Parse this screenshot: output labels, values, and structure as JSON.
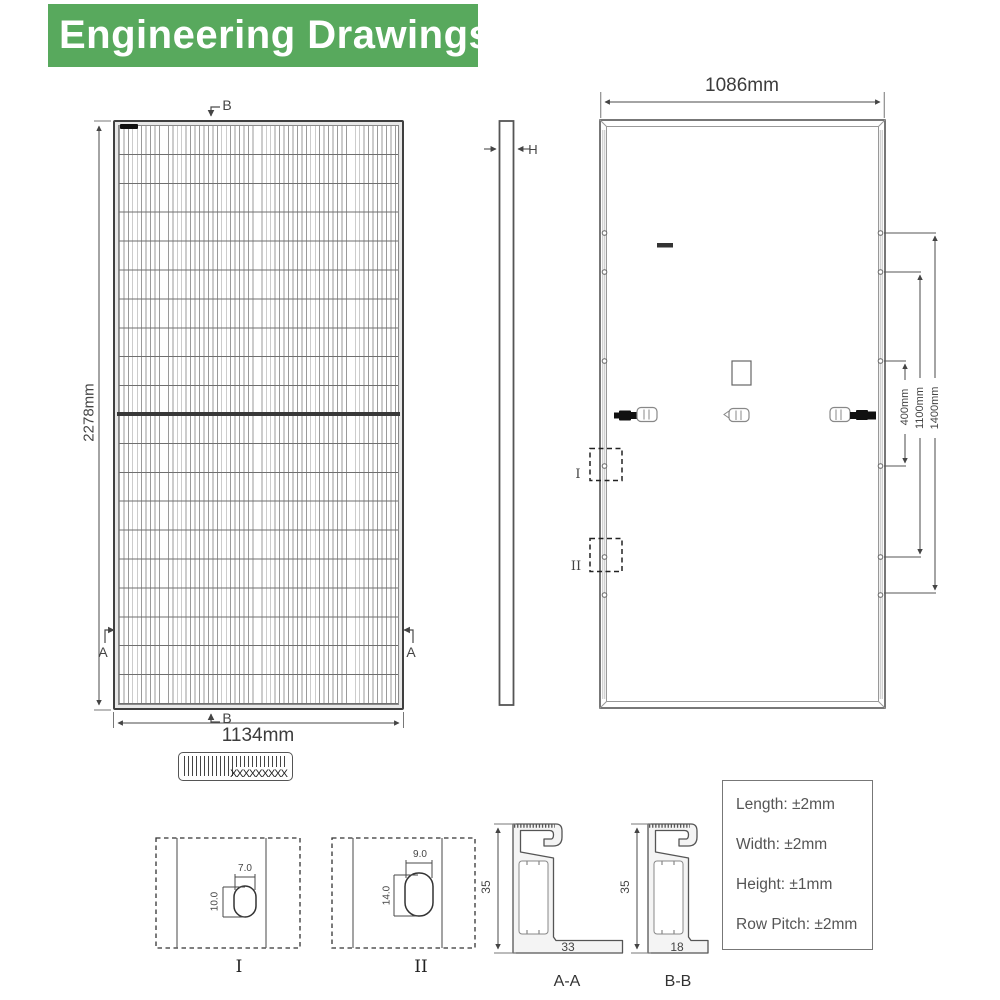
{
  "header": {
    "title": "Engineering Drawings",
    "bg_color": "#58a95d",
    "text_color": "#ffffff"
  },
  "front_view": {
    "height_dim": "2278mm",
    "width_dim": "1134mm",
    "section_b": "B",
    "section_a": "A"
  },
  "side_view": {
    "thickness_label": "H"
  },
  "back_view": {
    "width_dim": "1086mm",
    "hole_pitch_dims": [
      "400mm",
      "1100mm",
      "1400mm"
    ],
    "detail_marker_1": "I",
    "detail_marker_2": "II"
  },
  "barcode": {
    "text": "XXXXXXXXX"
  },
  "detail_views": {
    "detail_1": {
      "label": "I",
      "hole_width": "7.0",
      "hole_height": "10.0"
    },
    "detail_2": {
      "label": "II",
      "hole_width": "9.0",
      "hole_height": "14.0"
    }
  },
  "cross_sections": {
    "aa": {
      "label": "A-A",
      "height": "35",
      "base_width": "33"
    },
    "bb": {
      "label": "B-B",
      "height": "35",
      "base_width": "18"
    }
  },
  "tolerances": {
    "items": [
      "Length: ±2mm",
      "Width: ±2mm",
      "Height: ±1mm",
      "Row Pitch: ±2mm"
    ]
  },
  "colors": {
    "accent_green": "#58a95d",
    "line": "#4a4a4a"
  }
}
